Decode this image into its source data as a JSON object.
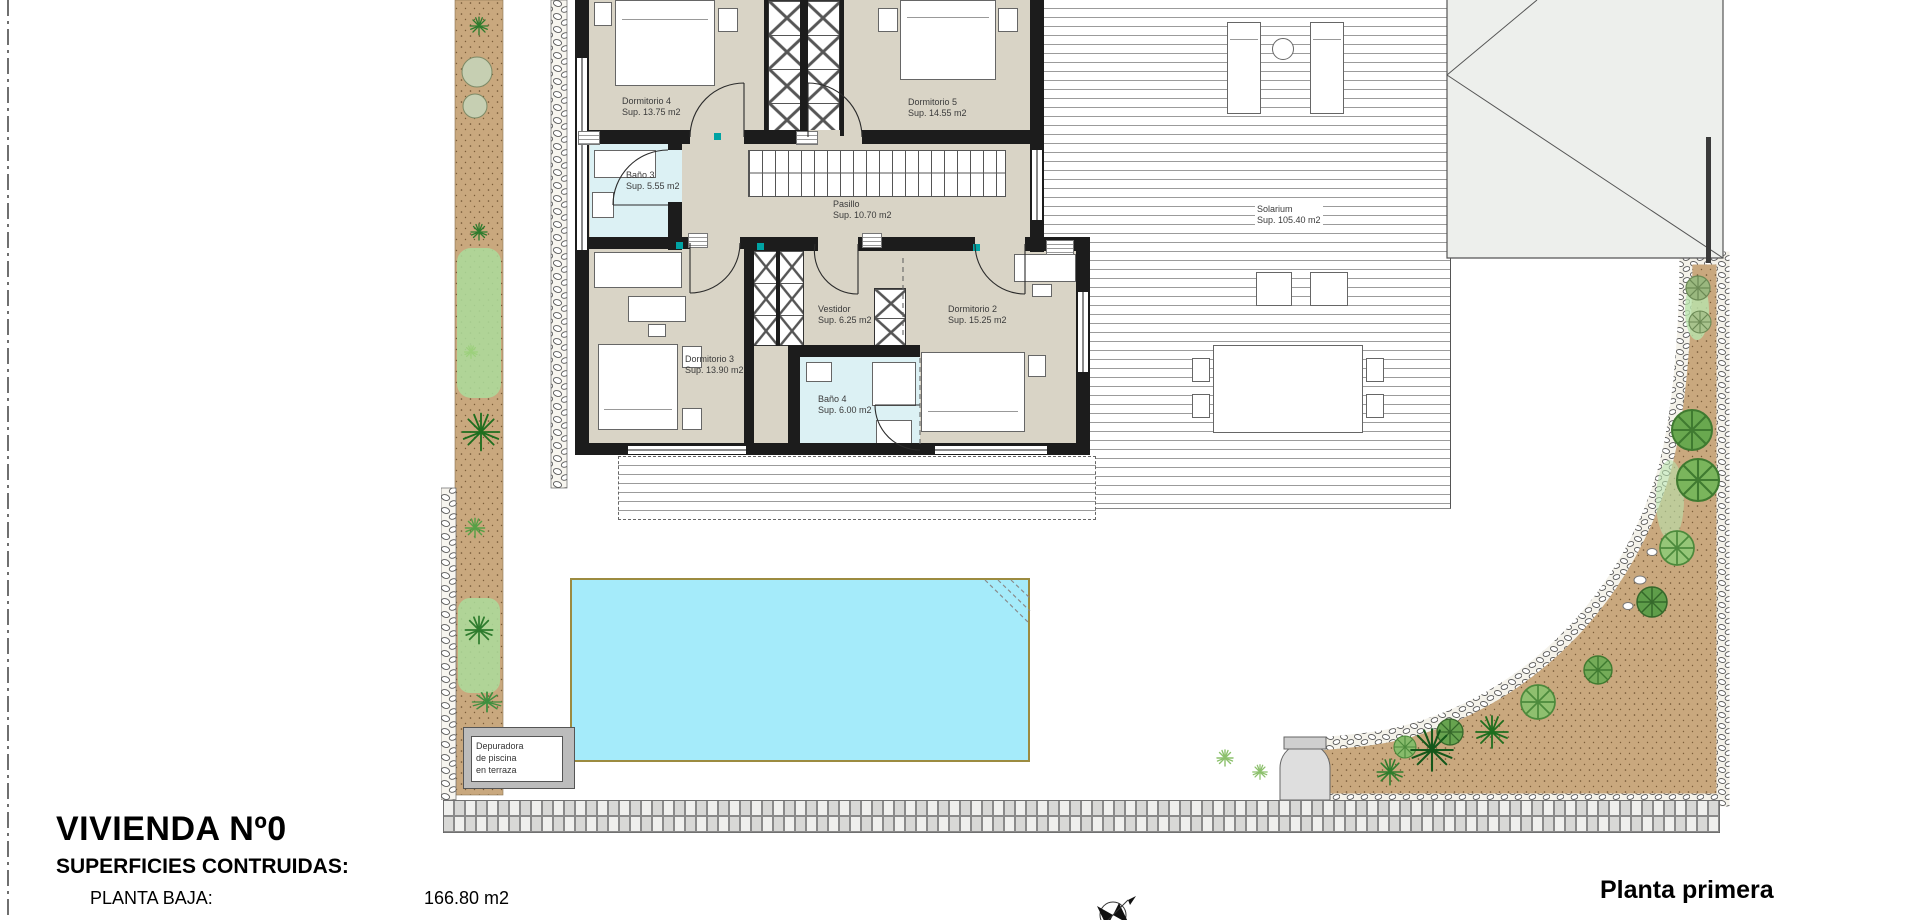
{
  "title_block": {
    "project": "VIVIENDA Nº0",
    "heading": "SUPERFICIES CONTRUIDAS:",
    "rows": [
      {
        "label": "PLANTA BAJA:",
        "value": "166.80 m2"
      }
    ]
  },
  "plan_caption": "Planta primera",
  "rooms": [
    {
      "id": "dormitorio-4",
      "name": "Dormitorio 4",
      "area": "Sup. 13.75 m2"
    },
    {
      "id": "dormitorio-5",
      "name": "Dormitorio 5",
      "area": "Sup. 14.55 m2"
    },
    {
      "id": "bano-3",
      "name": "Baño 3",
      "area": "Sup. 5.55 m2"
    },
    {
      "id": "pasillo",
      "name": "Pasillo",
      "area": "Sup. 10.70 m2"
    },
    {
      "id": "dormitorio-3",
      "name": "Dormitorio 3",
      "area": "Sup. 13.90 m2"
    },
    {
      "id": "vestidor",
      "name": "Vestidor",
      "area": "Sup. 6.25 m2"
    },
    {
      "id": "dormitorio-2",
      "name": "Dormitorio 2",
      "area": "Sup. 15.25 m2"
    },
    {
      "id": "bano-4",
      "name": "Baño 4",
      "area": "Sup. 6.00 m2"
    },
    {
      "id": "solarium",
      "name": "Solarium",
      "area": "Sup. 105.40 m2"
    }
  ],
  "annotations": {
    "pool_equipment_lines": [
      "Depuradora",
      "de piscina",
      "en terraza"
    ]
  },
  "colors": {
    "wall": "#1c1c1c",
    "room_floor": "#d9d4c6",
    "bath_floor": "#dcf1f4",
    "pool_water": "#a5ebfa",
    "pool_edge": "#9c8b40",
    "garden_soil": "#c9a87e",
    "teal_marker": "#00a3a3"
  }
}
